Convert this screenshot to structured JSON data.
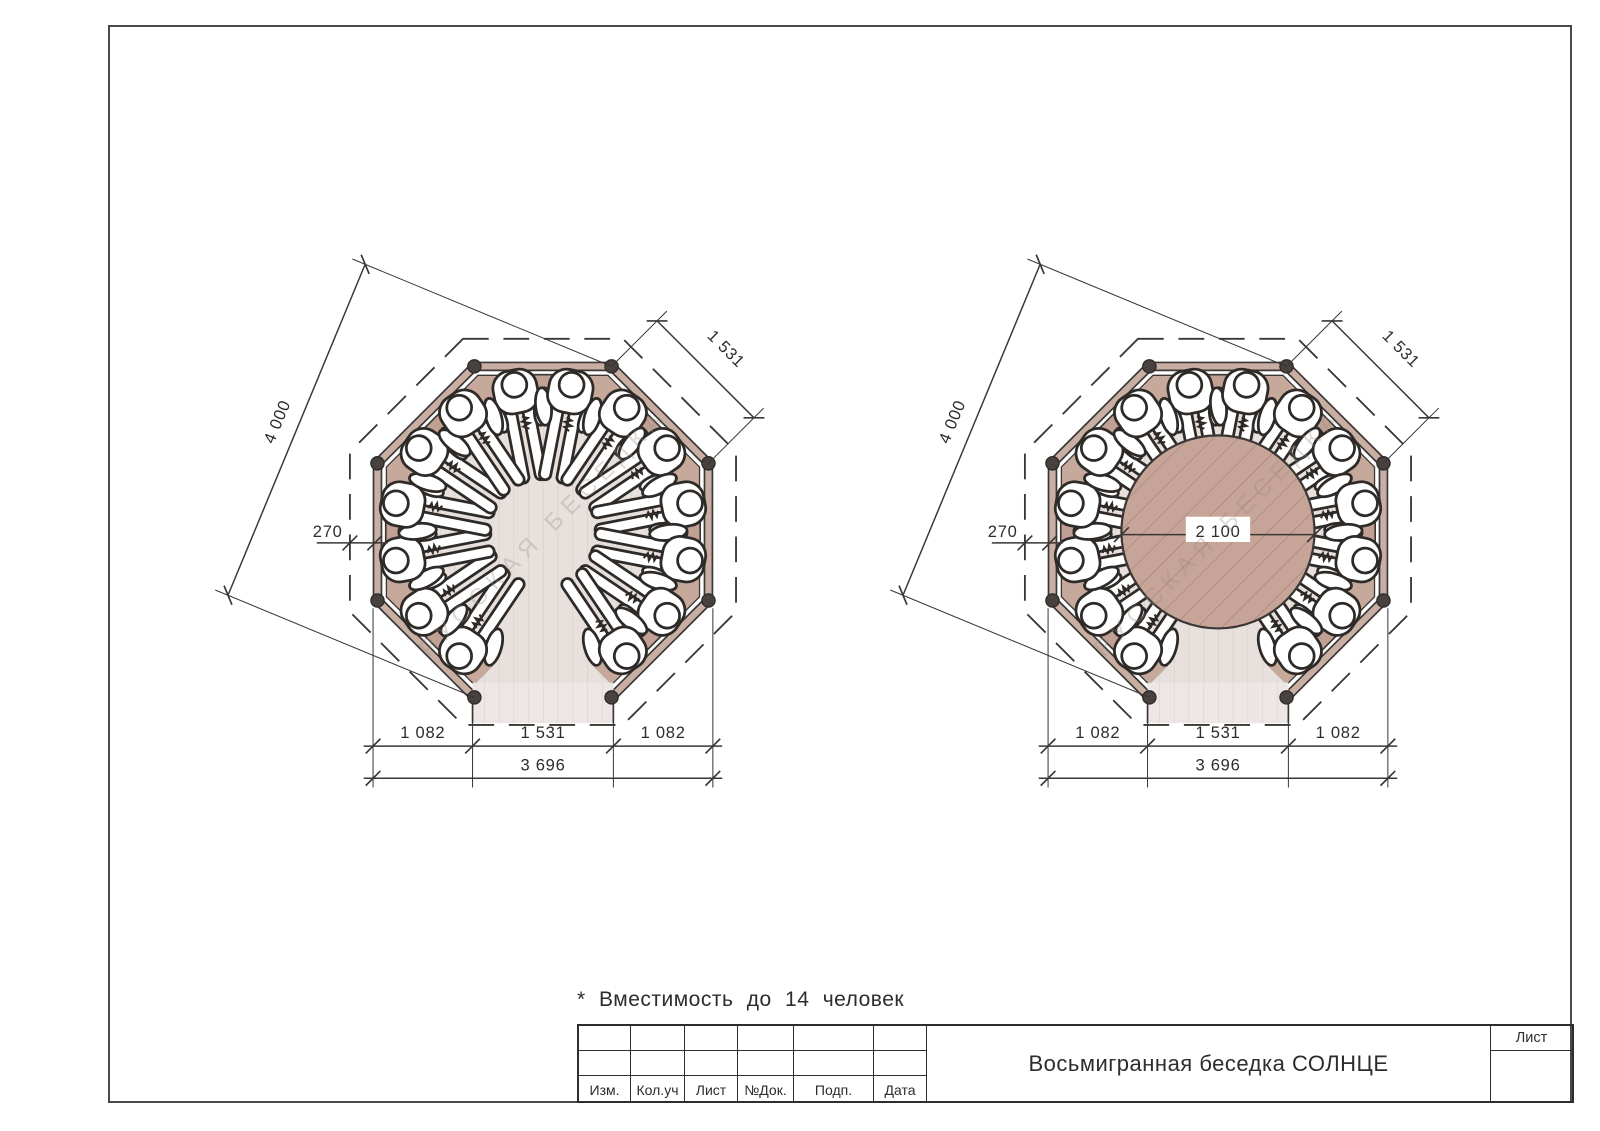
{
  "sheet": {
    "note": "* Вместимость до 14 человек",
    "watermark": "РУССКАЯ БЕСЕДКА"
  },
  "dimensions": {
    "diagonal_total": "4 000",
    "side_length": "1 531",
    "wall_offset": "270",
    "bottom_segments": [
      "1 082",
      "1 531",
      "1 082"
    ],
    "bottom_total": "3 696",
    "table_diameter": "2 100"
  },
  "title_block": {
    "title": "Восьмигранная беседка СОЛНЦЕ",
    "sheet_label": "Лист",
    "revision_columns": [
      "Изм.",
      "Кол.уч",
      "Лист",
      "№Док.",
      "Подп.",
      "Дата"
    ]
  },
  "colors": {
    "line": "#3a3735",
    "wall": "#c9afa3",
    "bench": "#c7a99c",
    "table": "#c6a498",
    "floor": "#e7e0dd",
    "post": "#474140"
  }
}
